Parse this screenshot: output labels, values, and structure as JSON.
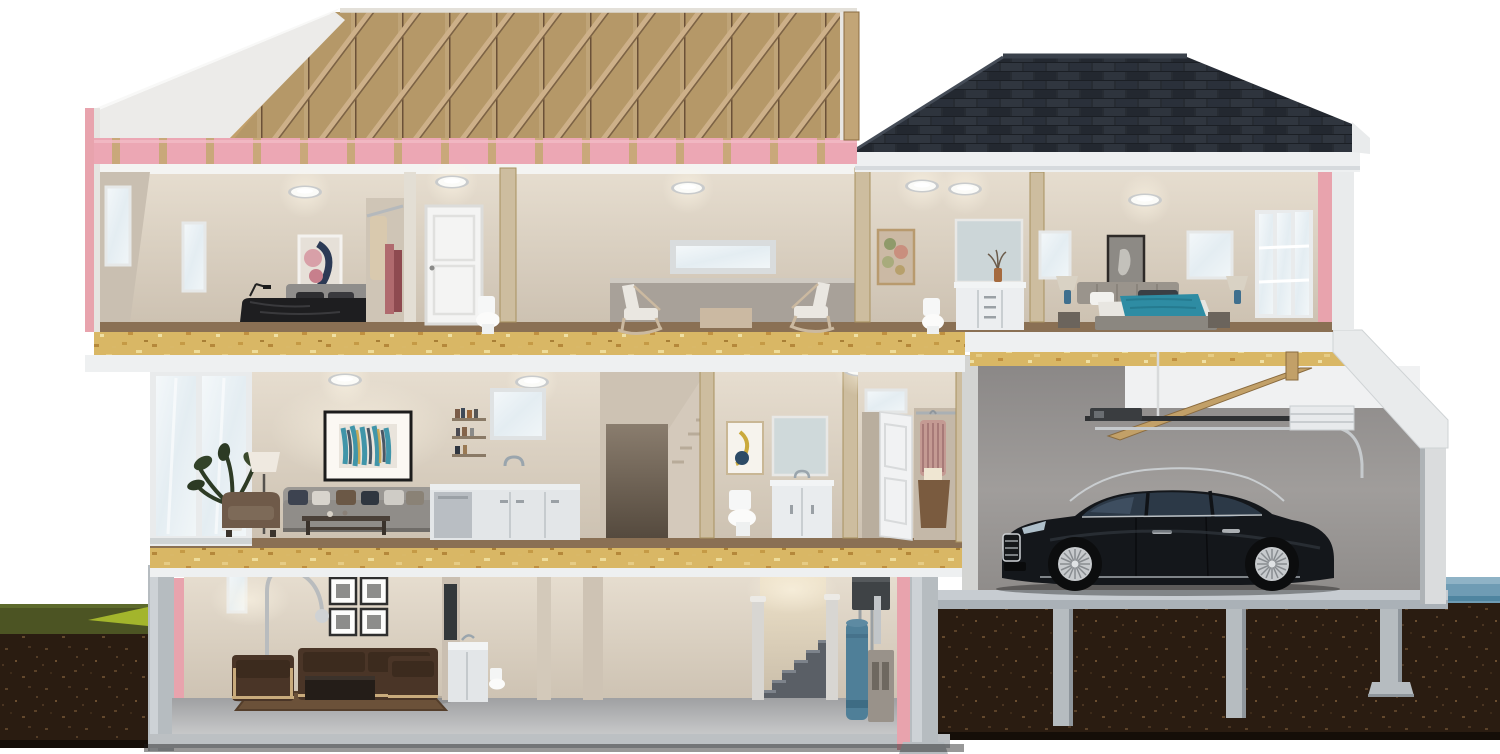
{
  "scene": {
    "title": "cutaway-cross-section-of-two-story-house-with-garage-and-basement",
    "floors": [
      {
        "name": "attic",
        "features": [
          "wood-roof-trusses",
          "osb-roof-sheathing",
          "pink-insulation-batts",
          "white-gable-wall"
        ]
      },
      {
        "name": "upper-floor",
        "rooms": [
          "bedroom-left",
          "closet",
          "bathroom-small",
          "loft-sitting-area",
          "bathroom-vanity",
          "bedroom-right"
        ]
      },
      {
        "name": "main-floor",
        "rooms": [
          "living-room",
          "kitchen",
          "stair-hallway",
          "powder-bathroom",
          "entry-closet",
          "garage"
        ]
      },
      {
        "name": "basement",
        "rooms": [
          "rec-room",
          "utility-area",
          "stairwell",
          "mechanical-corner"
        ]
      },
      {
        "name": "below-grade",
        "features": [
          "concrete-foundation-walls",
          "concrete-piers-with-footings",
          "soil-cross-section",
          "grass-strip",
          "water-table"
        ]
      }
    ],
    "objects": [
      "dark-bed-with-black-duvet",
      "abstract-wall-art",
      "hanging-clothes",
      "white-panel-door",
      "toilet",
      "two-rocking-chairs",
      "vanity-with-mirror",
      "bed-with-teal-throw",
      "horse-artwork",
      "blue-table-lamps",
      "gray-sofa-with-pillows",
      "teal-abstract-painting",
      "potted-plant",
      "floor-lamp",
      "white-kitchen-cabinets",
      "dishwasher",
      "kitchen-window",
      "front-door-open",
      "entry-closet-clothes",
      "black-luxury-sedan",
      "garage-door-opener",
      "rolled-up-garage-door",
      "wood-ceiling-beams",
      "brown-leather-sofa-set",
      "four-framed-prints",
      "arc-floor-lamp",
      "wall-tv",
      "utility-sink",
      "carpeted-stairs",
      "blue-water-heater",
      "furnace",
      "air-handler-unit"
    ]
  },
  "colors": {
    "sheathing": "#b59868",
    "trussLight": "#cdb089",
    "trussDark": "#7d6345",
    "stud": "#bfa478",
    "insulation": "#eca7b4",
    "insulationTick": "#c9a87a",
    "pink": "#e8a3ad",
    "shingle": "#272c33",
    "ridge": "#3a414b",
    "white": "#eef0f1",
    "ceiling": "#f4f4f2",
    "wall": "#d8cec0",
    "wallDark": "#c4b9aa",
    "osb": "#d9b765",
    "floorWood": "#8a7054",
    "glass": "#eef3f6",
    "garageWall": "#969392",
    "slab": "#c7ccd1",
    "concrete": "#b6bcc0",
    "soil": "#2a1c11",
    "grass": "#4c5423",
    "grassBright": "#a3b52c",
    "water": "#6f9cb4",
    "carBody": "#14171b",
    "carGlass": "#2c3947",
    "chrome": "#c9cdd0",
    "carpet": "#b7b8b9",
    "sofa": "#908d89",
    "leather": "#4a3527",
    "wood": "#6b5136",
    "teal": "#2e8ca3",
    "duvet": "#1e1e20",
    "heater": "#4f7f98",
    "furnace": "#99928a",
    "unit": "#3f4346"
  }
}
